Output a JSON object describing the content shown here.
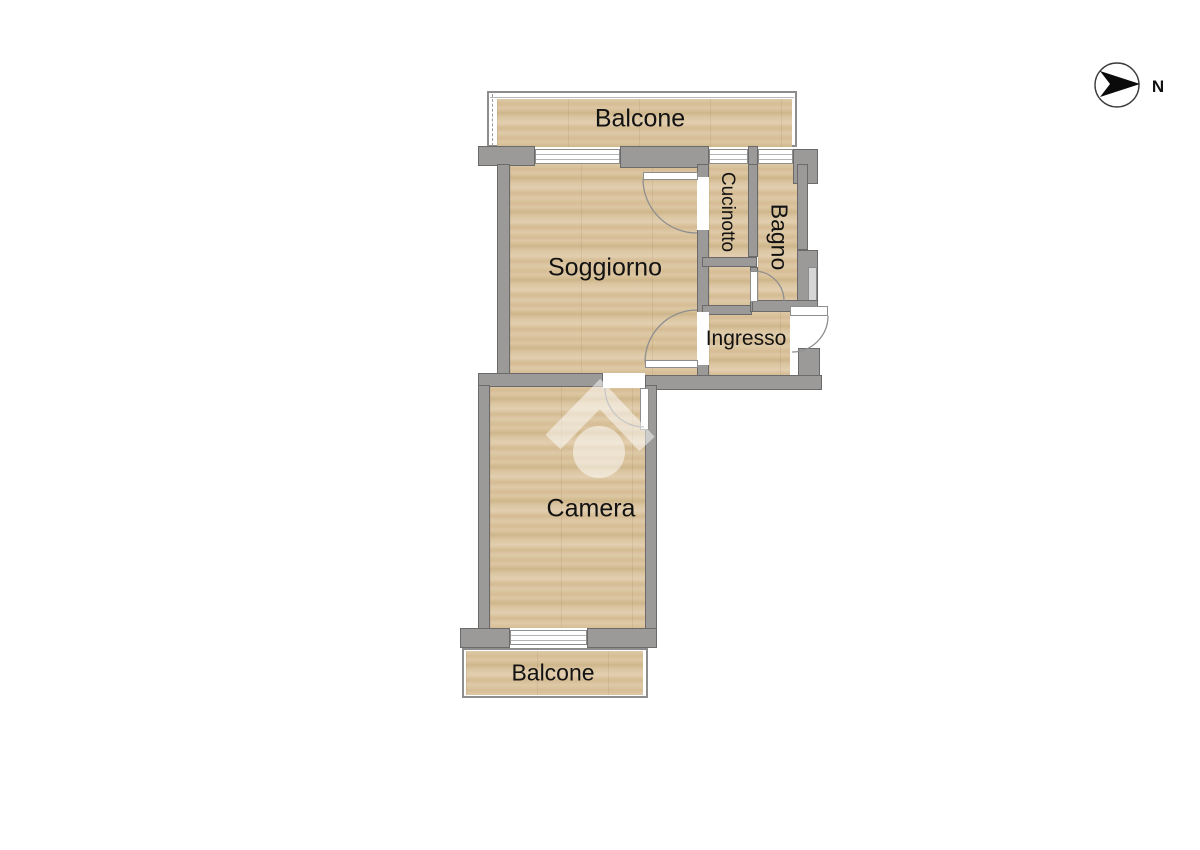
{
  "rooms": {
    "balcone_top": {
      "label": "Balcone"
    },
    "soggiorno": {
      "label": "Soggiorno"
    },
    "cucinotto": {
      "label": "Cucinotto"
    },
    "bagno": {
      "label": "Bagno"
    },
    "ingresso": {
      "label": "Ingresso"
    },
    "camera": {
      "label": "Camera"
    },
    "balcone_bottom": {
      "label": "Balcone"
    }
  },
  "compass": {
    "label": "N"
  },
  "icons": {
    "compass": "north-arrow-icon",
    "watermark": "house-logo-watermark-icon"
  },
  "colors": {
    "floor": "#d9c29e",
    "wall": "#9b9a99",
    "wall_outline": "#6a6a6a",
    "window": "#ffffff",
    "label_text": "#121212",
    "watermark": "rgba(255,255,255,0.5)"
  }
}
